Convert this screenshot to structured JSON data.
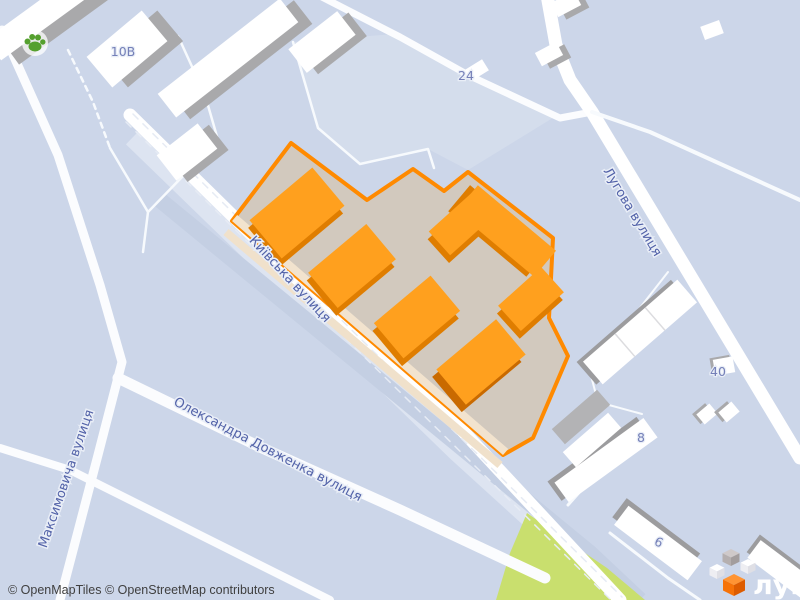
{
  "map": {
    "streets": {
      "kyivska": "Київська вулиця",
      "luhova": "Лугова вулиця",
      "dovzhenka": "Олександра Довженка вулиця",
      "maksymovycha": "Максимовича вулиця"
    },
    "house_numbers": {
      "b10v": "10В",
      "b24": "24",
      "b40": "40",
      "b8": "8",
      "b6": "6"
    },
    "poi": {
      "paw_icon": "pet-friendly-poi"
    },
    "highlight": {
      "type": "residential-complex-outline",
      "border_color": "#ff8a00",
      "area_fill": "#d2c9be",
      "building_fill": "#ffa01e",
      "building_shade": "#df7d00",
      "sidewalk_color": "#f2e3ce"
    },
    "colors": {
      "background": "#ccd6e9",
      "road": "#ffffff",
      "park_green": "#c9df6e",
      "building_white": "#ffffff",
      "building_shadow": "#a9a9ab",
      "label_blue": "#5262a8"
    }
  },
  "footer": {
    "attribution": "© OpenMapTiles © OpenStreetMap contributors"
  },
  "logo": {
    "text": "лун",
    "cube_orange": "#f67207"
  }
}
